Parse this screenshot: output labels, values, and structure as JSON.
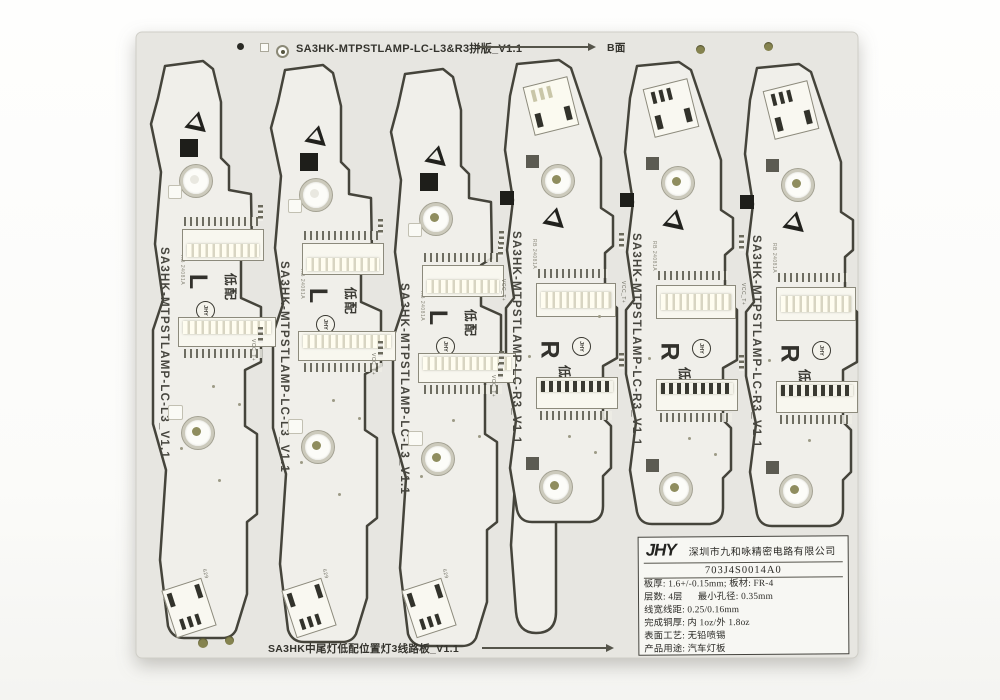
{
  "panel": {
    "top_title": "SA3HK-MTPSTLAMP-LC-L3&R3拼版_V1.1",
    "top_side_label": "B面",
    "bottom_title": "SA3HK中尾灯低配位置灯3线路板_V1.1"
  },
  "boards": [
    {
      "label": "SA3HK-MTPSTLAMP-LC-L3_V1.1",
      "marking": "L",
      "config": "低配",
      "logo": "JHY",
      "date_code": "RB 24081A"
    },
    {
      "label": "SA3HK-MTPSTLAMP-LC-L3_V1.1",
      "marking": "L",
      "config": "低配",
      "logo": "JHY",
      "date_code": "RB 24081A"
    },
    {
      "label": "SA3HK-MTPSTLAMP-LC-L3_V1.1",
      "marking": "L",
      "config": "低配",
      "logo": "JHY",
      "date_code": "RB 24081A"
    },
    {
      "label": "SA3HK-MTPSTLAMP-LC-R3_V1.1",
      "marking": "R",
      "config": "低配",
      "logo": "JHY",
      "date_code": "RB 24081A"
    },
    {
      "label": "SA3HK-MTPSTLAMP-LC-R3_V1.1",
      "marking": "R",
      "config": "低配",
      "logo": "JHY",
      "date_code": "RB 24081A"
    },
    {
      "label": "SA3HK-MTPSTLAMP-LC-R3_V1.1",
      "marking": "R",
      "config": "低配",
      "logo": "JHY",
      "date_code": "RB 24081A"
    }
  ],
  "silkscreen": {
    "vcc_label": "VCC_T+",
    "tilt_label": "629"
  },
  "sticker": {
    "logo": "JHY",
    "company": "深圳市九和咏精密电路有限公司",
    "part_number": "703J4S0014A0",
    "specs": [
      "板厚: 1.6+/-0.15mm; 板材: FR-4",
      "层数: 4层      最小孔径: 0.35mm",
      "线宽线距: 0.25/0.16mm",
      "完成铜厚: 内 1oz/外 1.8oz",
      "表面工艺: 无铅喷锡",
      "产品用途: 汽车灯板"
    ]
  },
  "colors": {
    "background": "#fdfdfc",
    "panel": "#e7e6e1",
    "board": "#f0efea",
    "routed_outline": "#45443b",
    "silkscreen": "#3c3b35",
    "pad_bright": "#fbf9ec",
    "hole_olive": "#8f8d5e"
  }
}
